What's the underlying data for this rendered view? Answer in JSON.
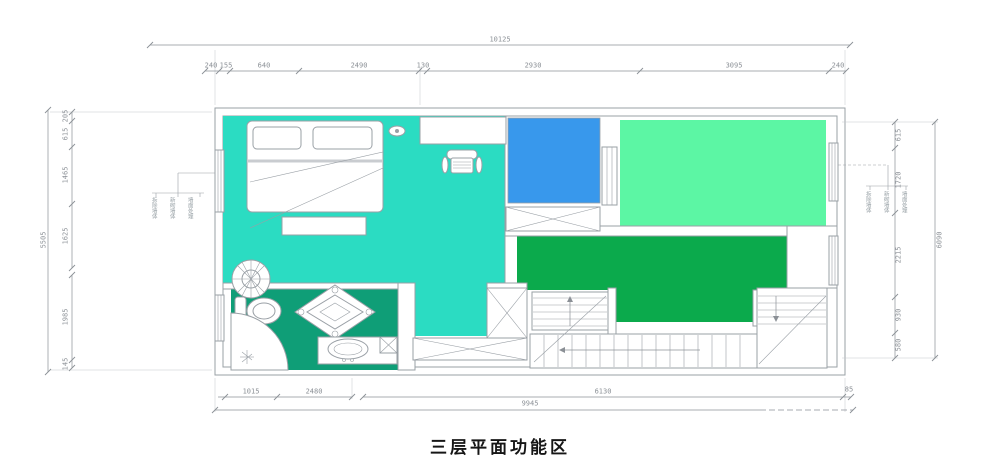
{
  "title": "三层平面功能区",
  "colors": {
    "c-teal": "#2bdcc2",
    "c-blue": "#3898ec",
    "c-mint": "#5cf6a4",
    "c-green": "#0baa4c",
    "c-emerald": "#0f9e77",
    "c-line": "#9aa0a6",
    "c-dim": "#8b9096"
  },
  "dim_labels": [
    {
      "text": "10125",
      "x": 500,
      "y": 40,
      "rot": 0
    },
    {
      "text": "240",
      "x": 211,
      "y": 66,
      "rot": 0
    },
    {
      "text": "155",
      "x": 226,
      "y": 66,
      "rot": 0
    },
    {
      "text": "640",
      "x": 264,
      "y": 66,
      "rot": 0
    },
    {
      "text": "2490",
      "x": 359,
      "y": 66,
      "rot": 0
    },
    {
      "text": "130",
      "x": 423,
      "y": 66,
      "rot": 0
    },
    {
      "text": "2930",
      "x": 533,
      "y": 66,
      "rot": 0
    },
    {
      "text": "3095",
      "x": 734,
      "y": 66,
      "rot": 0
    },
    {
      "text": "240",
      "x": 838,
      "y": 66,
      "rot": 0
    },
    {
      "text": "5505",
      "x": 44,
      "y": 240,
      "rot": -90
    },
    {
      "text": "205",
      "x": 66,
      "y": 116,
      "rot": -90
    },
    {
      "text": "615",
      "x": 66,
      "y": 134,
      "rot": -90
    },
    {
      "text": "1465",
      "x": 66,
      "y": 175,
      "rot": -90
    },
    {
      "text": "1625",
      "x": 66,
      "y": 236,
      "rot": -90
    },
    {
      "text": "1985",
      "x": 66,
      "y": 317,
      "rot": -90
    },
    {
      "text": "145",
      "x": 66,
      "y": 364,
      "rot": -90
    },
    {
      "text": "615",
      "x": 899,
      "y": 135,
      "rot": -90
    },
    {
      "text": "1720",
      "x": 899,
      "y": 180,
      "rot": -90
    },
    {
      "text": "2215",
      "x": 899,
      "y": 255,
      "rot": -90
    },
    {
      "text": "930",
      "x": 899,
      "y": 315,
      "rot": -90
    },
    {
      "text": "580",
      "x": 899,
      "y": 345,
      "rot": -90
    },
    {
      "text": "6090",
      "x": 940,
      "y": 240,
      "rot": -90
    },
    {
      "text": "1015",
      "x": 251,
      "y": 392,
      "rot": 0
    },
    {
      "text": "2480",
      "x": 314,
      "y": 392,
      "rot": 0
    },
    {
      "text": "6130",
      "x": 603,
      "y": 392,
      "rot": 0
    },
    {
      "text": "85",
      "x": 849,
      "y": 390,
      "rot": 0
    },
    {
      "text": "9945",
      "x": 530,
      "y": 404,
      "rot": 0
    }
  ],
  "wall_notes": {
    "left": {
      "lines": [
        "拆除墙体",
        "新砌墙体",
        "墙面处理"
      ]
    },
    "right": {
      "lines": [
        "拆除墙体",
        "新砌墙体",
        "墙面处理"
      ]
    }
  }
}
